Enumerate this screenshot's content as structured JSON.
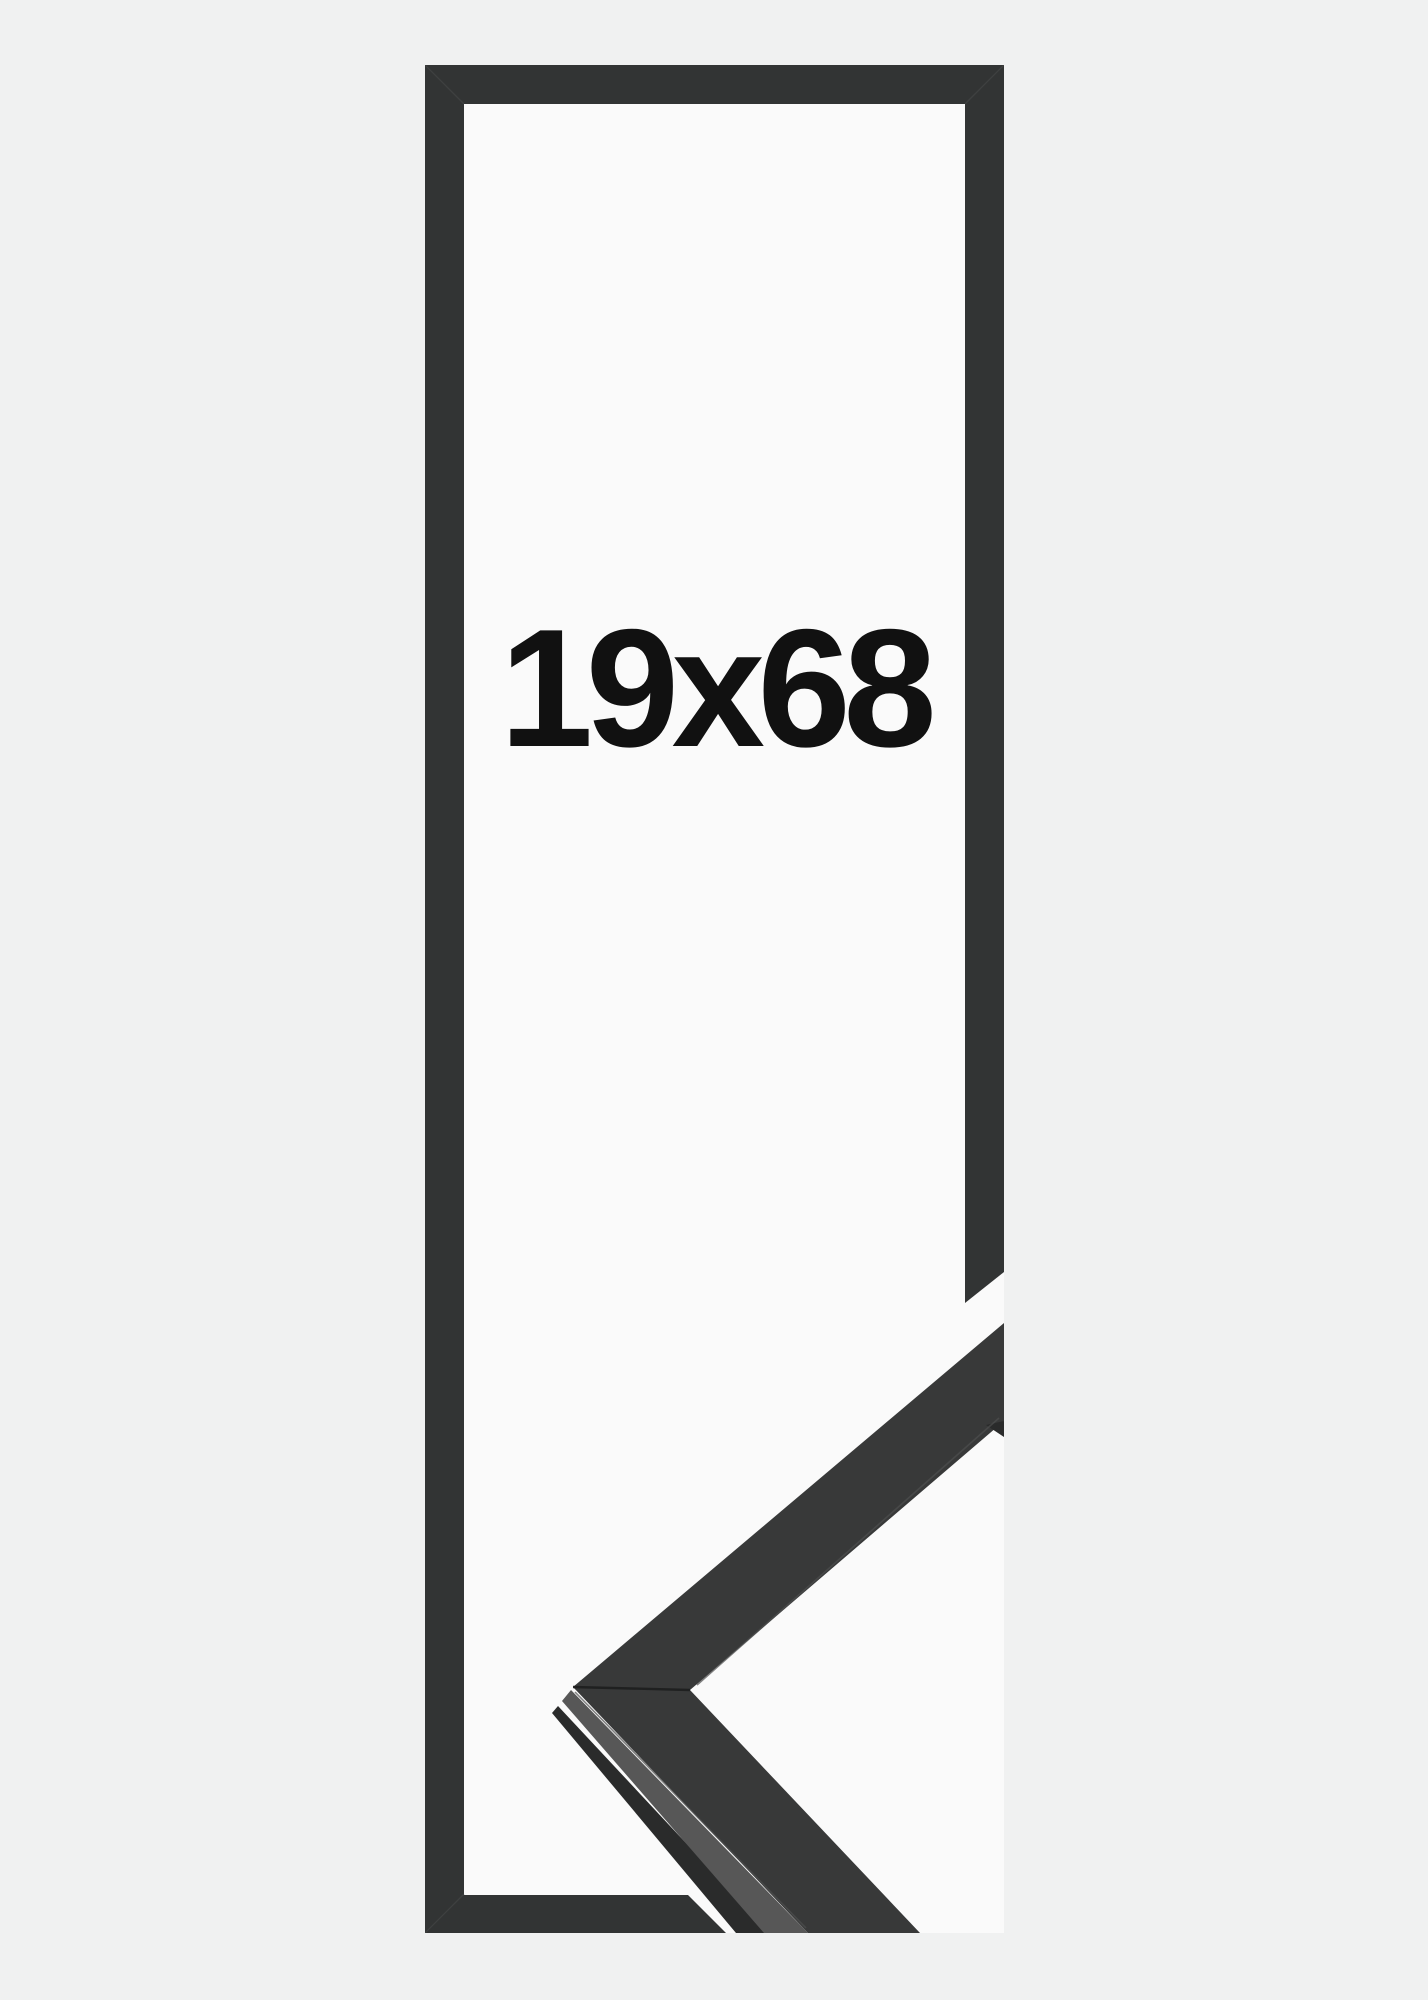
{
  "product": {
    "size_label": "19x68"
  },
  "frame": {
    "style": "black-outline-frame",
    "parts": [
      "top-bar",
      "left-bar",
      "bottom-bar-cut",
      "right-bar-cut",
      "moulding-corner-sample"
    ]
  },
  "colors": {
    "page-bg": "#f0f1f1",
    "canvas-bg": "#fafafa",
    "outline": "#323434",
    "moulding-face": "#383939",
    "moulding-side": "#575757",
    "moulding-edge": "#2a2b2b",
    "label-text": "#111111"
  }
}
